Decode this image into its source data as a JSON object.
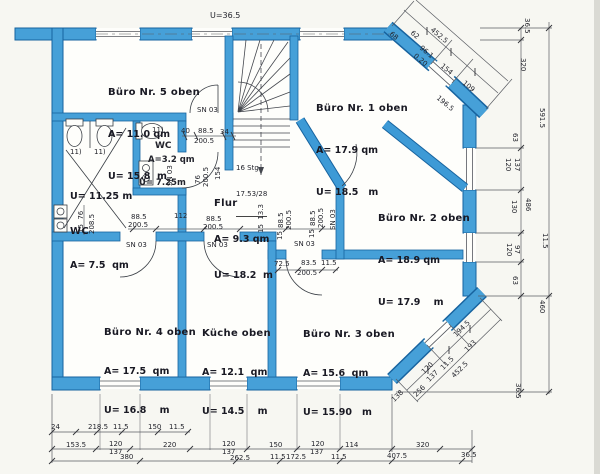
{
  "plan": {
    "outer_perimeter_label": "U=36.5",
    "rooms": [
      {
        "name": "Büro Nr. 5 oben",
        "area": "A= 11.0 qm",
        "perimeter": "U= 15.8  m"
      },
      {
        "name": "Büro Nr. 1 oben",
        "area": "A= 17.9 qm",
        "perimeter": "U= 18.5   m"
      },
      {
        "name": "Büro Nr. 2 oben",
        "area": "A= 18.9 qm",
        "perimeter": "U= 17.9    m"
      },
      {
        "name": "WC",
        "area": "A= 7.5  qm",
        "perimeter": "U= 11.25 m"
      },
      {
        "name": "WC",
        "area": "A=3.2 qm",
        "perimeter": "U= 7.25m"
      },
      {
        "name": "Flur",
        "area": "A= 9.3 qm",
        "perimeter": "U= 18.2  m"
      },
      {
        "name": "Büro Nr. 4 oben",
        "area": "A= 17.5  qm",
        "perimeter": "U= 16.8    m"
      },
      {
        "name": "Küche oben",
        "area": "A= 12.1  qm",
        "perimeter": "U= 14.5    m"
      },
      {
        "name": "Büro Nr. 3 oben",
        "area": "A= 15.6  qm",
        "perimeter": "U= 15.90   m"
      }
    ],
    "stair": {
      "line1": "16 Stg",
      "line2": "17.53/28"
    },
    "door_tag": "SN 03",
    "fixture_tag": "11)",
    "dims": {
      "tr": [
        "68",
        "62",
        "96.1",
        "0.20",
        "154",
        "109",
        "196.5",
        "452.5"
      ],
      "right": [
        "36.5",
        "320",
        "591.5",
        "63",
        "120",
        "137",
        "130",
        "486",
        "120",
        "97",
        "63",
        "11.5",
        "460",
        "36.5"
      ],
      "bottom_a": [
        "24",
        "218.5",
        "11.5",
        "150",
        "11.5"
      ],
      "bottom_b": [
        "153.5",
        "120",
        "137",
        "220",
        "120",
        "137",
        "150",
        "120",
        "137",
        "114",
        "320"
      ],
      "bottom_c": [
        "380",
        "262.5",
        "11.5",
        "172.5",
        "11.5",
        "407.5",
        "36.5"
      ],
      "br": [
        "138",
        "256",
        "120",
        "137",
        "11.5",
        "452.5",
        "194.5",
        "193"
      ],
      "stair_door": [
        "40",
        "88.5",
        "34",
        "200.5"
      ],
      "wc_vert": [
        "15  76",
        "208.5"
      ],
      "small_wc_vert": [
        "76",
        "200.5",
        "154"
      ],
      "center": [
        "88.5",
        "200.5",
        "112",
        "88.5",
        "200.5",
        "15  13.3",
        "88.5",
        "200.5",
        "15",
        "88.5",
        "200.5",
        "15"
      ],
      "b3": [
        "72.5",
        "83.5",
        "11.5",
        "200.5"
      ]
    }
  }
}
